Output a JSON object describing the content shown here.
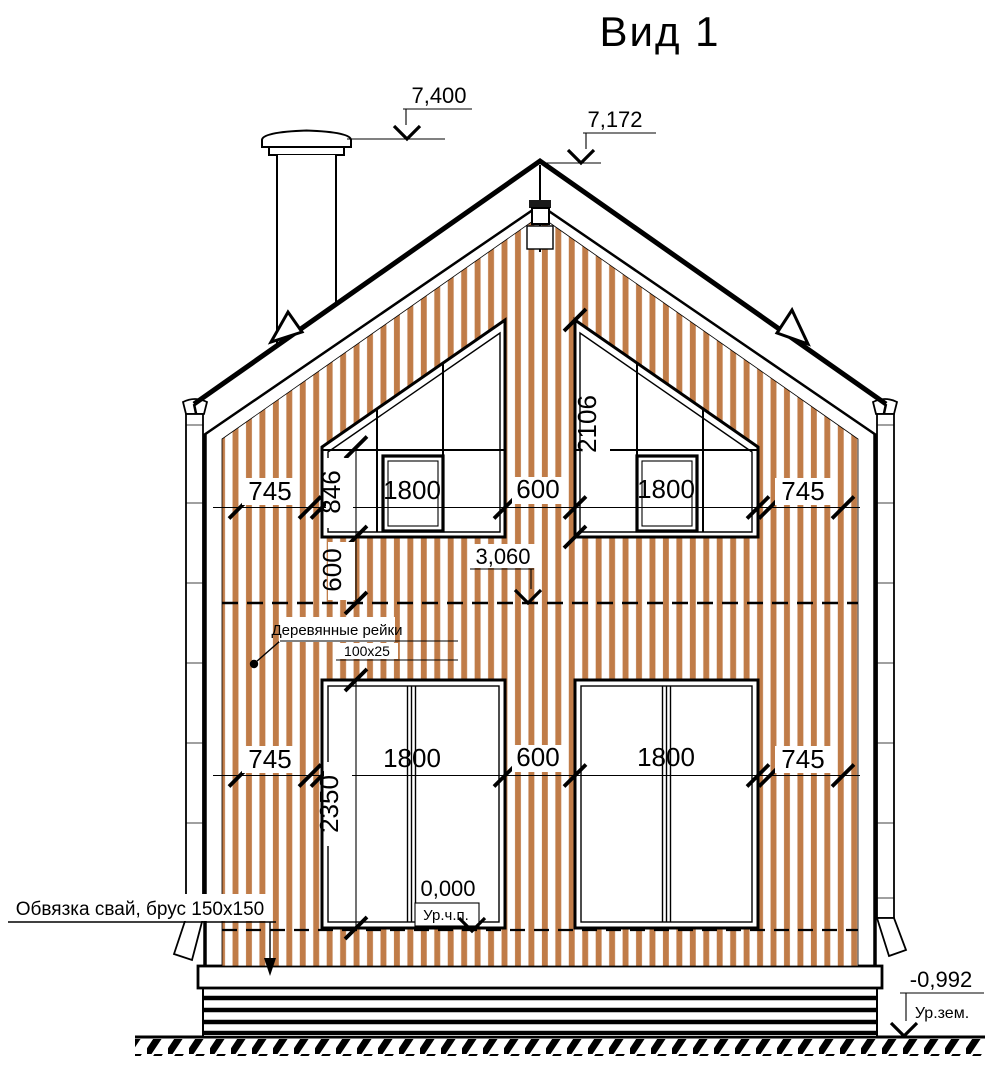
{
  "title": "Вид 1",
  "colors": {
    "siding": "#c07c48",
    "line": "#000000"
  },
  "levels": {
    "chimney_top": "7,400",
    "ridge": "7,172",
    "floor2": "3,060",
    "floor1": "0,000",
    "floor1_label": "Ур.ч.п.",
    "ground": "-0,992",
    "ground_label": "Ур.зем."
  },
  "dims": {
    "upper": [
      "745",
      "1800",
      "600",
      "1800",
      "745"
    ],
    "lower": [
      "745",
      "1800",
      "600",
      "1800",
      "745"
    ],
    "win_left_side": "846",
    "win_under": "600",
    "win_right_height": "2106",
    "win_lower_height": "2350"
  },
  "notes": {
    "battens_1": "Деревянные рейки",
    "battens_2": "100х25",
    "piles": "Обвязка свай, брус 150х150"
  }
}
